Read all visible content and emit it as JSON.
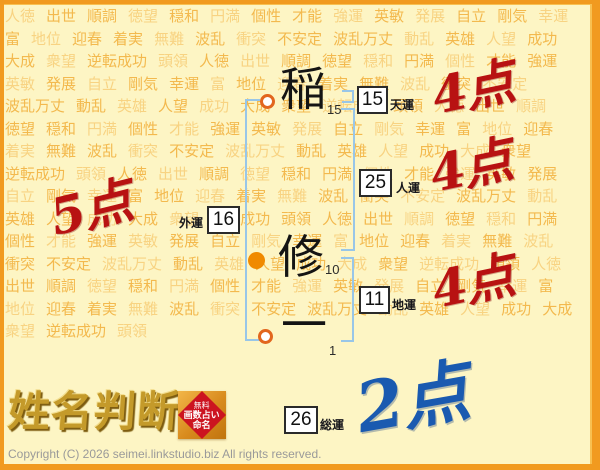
{
  "background": {
    "words": [
      "人徳",
      "出世",
      "順調",
      "徳望",
      "穏和",
      "円満",
      "個性",
      "才能",
      "強運",
      "英敏",
      "発展",
      "自立",
      "剛気",
      "幸運",
      "富",
      "地位",
      "迎春",
      "着実",
      "無難",
      "波乱",
      "衝突",
      "不安定",
      "波乱万丈",
      "動乱",
      "英雄",
      "人望",
      "成功",
      "大成",
      "衆望",
      "逆転成功",
      "頭領"
    ],
    "repeat": 6
  },
  "name": {
    "chars": [
      {
        "char": "稲",
        "strokes": "15"
      },
      {
        "char": "修",
        "strokes": "10"
      },
      {
        "char": "一",
        "strokes": "1"
      }
    ]
  },
  "fortunes": {
    "ten": {
      "label": "天運",
      "value": "15",
      "score": "4点"
    },
    "jin": {
      "label": "人運",
      "value": "25",
      "score": "4点"
    },
    "chi": {
      "label": "地運",
      "value": "11",
      "score": "4点"
    },
    "gai": {
      "label": "外運",
      "value": "16",
      "score": "5点"
    },
    "sou": {
      "label": "総運",
      "value": "26",
      "score": "2点"
    }
  },
  "logo": {
    "title": "姓名判断",
    "seal": {
      "line1": "無料",
      "line2": "画数占い",
      "line3": "命名"
    }
  },
  "footer": {
    "copyright": "Copyright (C) 2026 seimei.linkstudio.biz All rights reserved."
  },
  "colors": {
    "frame_border": "#f19a1f",
    "background": "#fdf5c4",
    "background_words": "#f3b94e",
    "bracket_blue": "#98c6e8",
    "score_red": "#b81212",
    "score_blue": "#1a5ab0",
    "marker_orange": "#f08a00",
    "seal_red": "#cc1420"
  }
}
